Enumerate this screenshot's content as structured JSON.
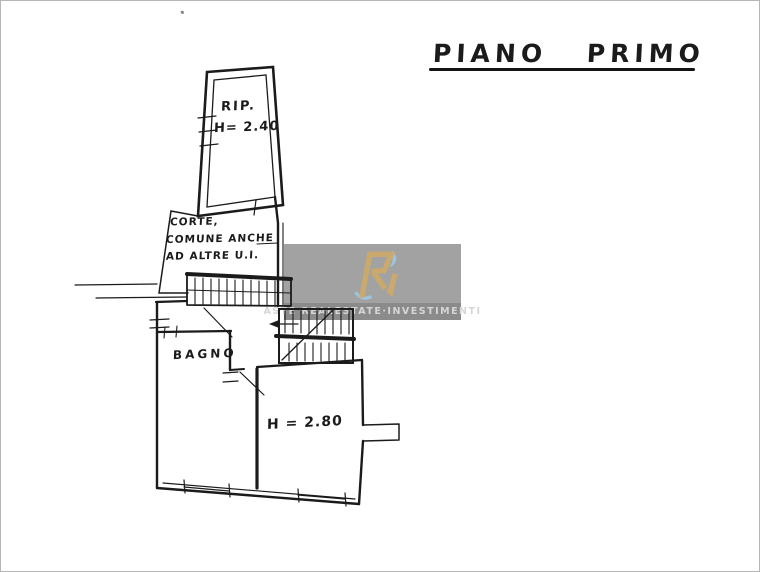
{
  "document": {
    "title": "PIANO PRIMO"
  },
  "plan": {
    "rooms": {
      "rip": {
        "label": "RIP.",
        "height_label": "H= 2.40"
      },
      "corte": {
        "line1": "CORTE,",
        "line2": "COMUNE ANCHE",
        "line3": "AD ALTRE U.I."
      },
      "bagno": {
        "label": "BAGNO"
      },
      "main_room": {
        "height_label": "H = 2.80"
      }
    },
    "ink_color": "#1b1b1b"
  },
  "watermark": {
    "monogram": "Ri",
    "text": "ASTE REALESTATE·INVESTIMENTI",
    "colors": {
      "background": "#a2a2a2",
      "band": "#8b8b8b",
      "band_text": "#d6d6d6",
      "gold": "#c9a96d",
      "flame_blue": "#9cc8e4"
    }
  }
}
